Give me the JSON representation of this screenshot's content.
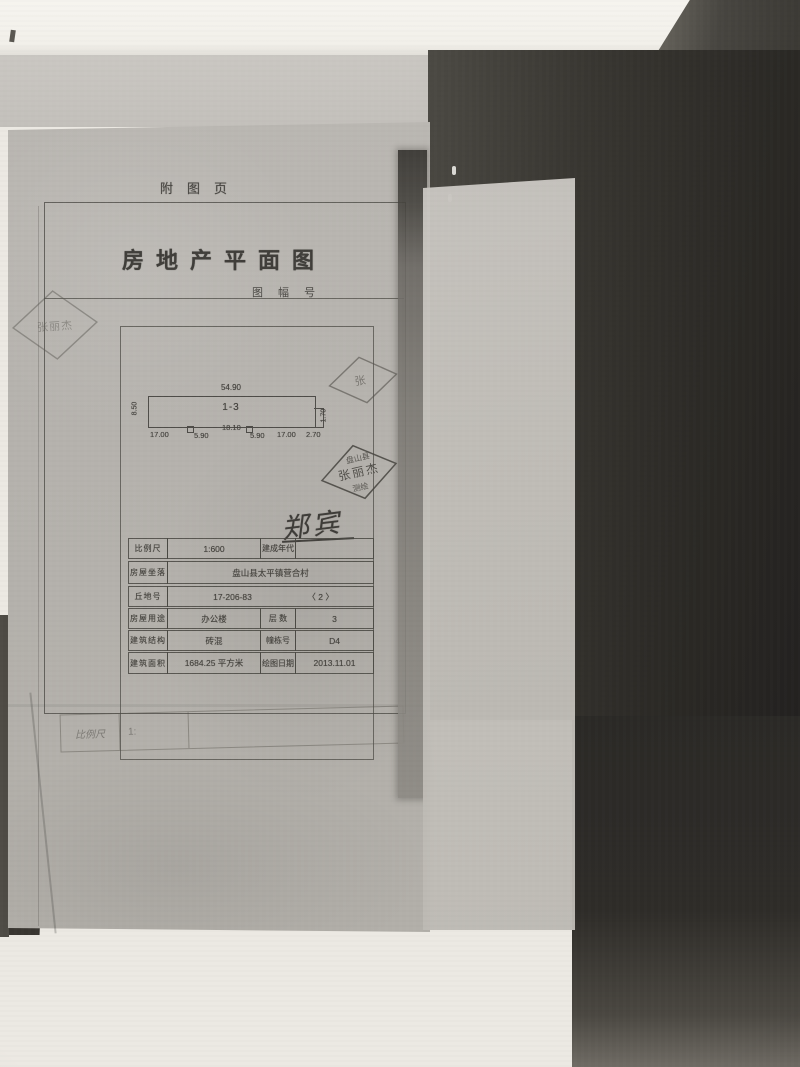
{
  "page": {
    "attachment_label": "附图页",
    "title": "房地产平面图",
    "sheet_no_label": "图 幅 号"
  },
  "plan": {
    "unit_label": "1-3",
    "top_dim": "54.90",
    "left_dim": "8.50",
    "right_dim": "1.70",
    "bottom_dims": [
      "17.00",
      "5.90",
      "18.10",
      "5.90",
      "17.00",
      "2.70"
    ]
  },
  "stamps": {
    "ghost_left": "张丽杰",
    "ghost_right": "张",
    "seal_top": "盘山县",
    "seal_name": "张丽杰",
    "seal_bottom": "测绘",
    "signature": "郑宾"
  },
  "table": {
    "rows": [
      {
        "l1": "比例尺",
        "v1": "1:600",
        "l2": "建成年代",
        "v2": ""
      },
      {
        "l1": "房屋坐落",
        "v1": "盘山县太平镇营合村"
      },
      {
        "l1": "丘地号",
        "v1": "17-206-83",
        "v1b": "〈 2 〉"
      },
      {
        "l1": "房屋用途",
        "v1": "办公楼",
        "l2": "层 数",
        "v2": "3"
      },
      {
        "l1": "建筑结构",
        "v1": "砖混",
        "l2": "幢栋号",
        "v2": "D4"
      },
      {
        "l1": "建筑面积",
        "v1": "1684.25  平方米",
        "l2": "绘图日期",
        "v2": "2013.11.01"
      }
    ]
  },
  "lower_sheet": {
    "scale_label": "比例尺",
    "scale_value": "1:"
  }
}
